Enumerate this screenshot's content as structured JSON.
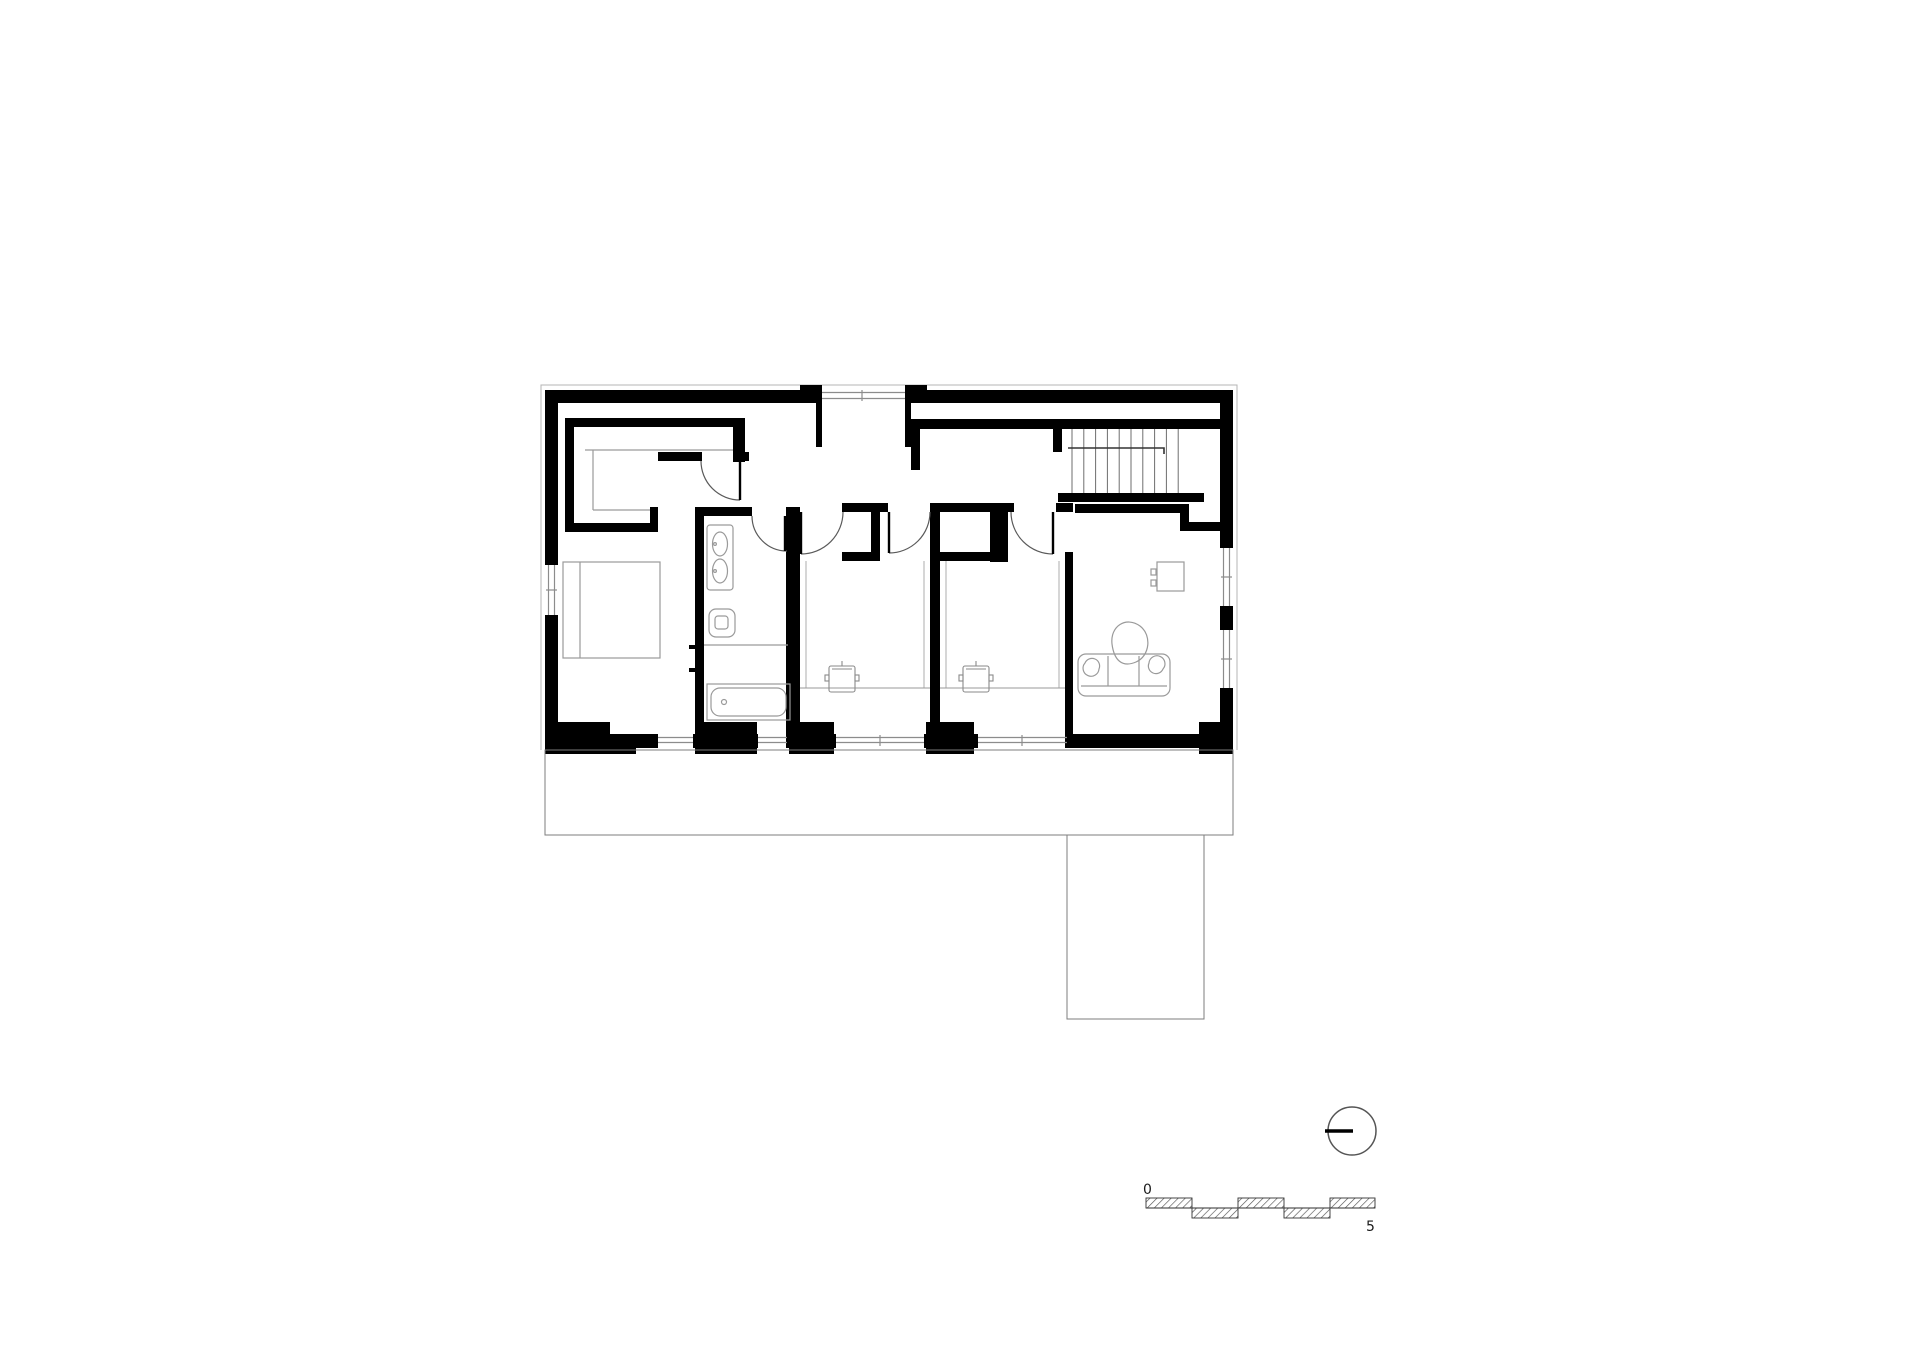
{
  "page": {
    "background": "#ffffff",
    "kind": "architectural floor plan drawing"
  },
  "scale_bar": {
    "start_label": "0",
    "end_label": "5"
  },
  "symbols": {
    "north_indicator_icon": "circle-with-west-pointer"
  },
  "colors": {
    "wall": "#000000",
    "furniture_line": "#9a9a9a",
    "glazing_line": "#8c8c8c",
    "terrace_outline": "#7d7d7d",
    "stair_tread": "#6e6e6e",
    "door_arc": "#5a5a5a",
    "scale_text": "#1a1a1a"
  }
}
